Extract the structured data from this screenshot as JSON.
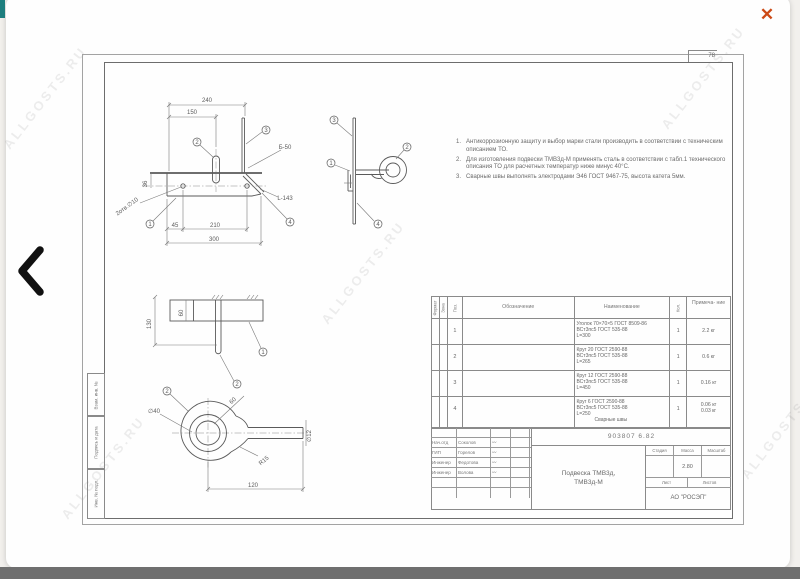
{
  "viewer": {
    "close_glyph": "✕",
    "watermark": "ALLGOSTS.RU"
  },
  "sheet": {
    "page_number": "78",
    "margin_labels": {
      "vzam": "Взам. инв. №",
      "podpis": "Подпись и дата",
      "inv": "Инв. № подл."
    }
  },
  "notes": {
    "items": [
      {
        "num": "1.",
        "text": "Антикоррозионную защиту и выбор марки стали производить в соответствии с техническим описанием ТО."
      },
      {
        "num": "2.",
        "text": "Для изготовления подвески ТМВ3д-М применять сталь в соответствии с табл.1 технического описания ТО для расчетных температур ниже минус 40°С."
      },
      {
        "num": "3.",
        "text": "Сварные швы выполнять электродами Э46 ГОСТ 9467-75, высота катета 5мм."
      }
    ]
  },
  "views": {
    "v1": {
      "dim_240": "240",
      "dim_150": "150",
      "dim_36": "36",
      "dim_45": "45",
      "dim_210": "210",
      "dim_300": "300",
      "holes_label": "2отв.∅10",
      "weld_label": "Б-50",
      "right_label": "L-143",
      "balloon_1": "1",
      "balloon_2": "2",
      "balloon_3": "3",
      "balloon_4": "4"
    },
    "v2": {
      "balloon_1": "1",
      "balloon_2": "2",
      "balloon_3": "3",
      "balloon_4": "4"
    },
    "v3": {
      "dim_130": "130",
      "dim_60": "60",
      "balloon_1": "1",
      "balloon_2": "2"
    },
    "v4": {
      "dim_60": "60",
      "dia_40": "∅40",
      "r_15": "R15",
      "dia_12": "∅12",
      "dim_120": "120",
      "balloon_2": "2"
    }
  },
  "spec_table": {
    "headers": {
      "format": "Формат",
      "zone": "Зона",
      "pos": "Поз.",
      "designation": "Обозначение",
      "name": "Наименование",
      "qty": "Кол.",
      "note": "Примеча- ние"
    },
    "rows": [
      {
        "pos": "1",
        "name_l1": "Уголок 70×70×5 ГОСТ 8509-86",
        "name_l2": "ВСт3пс5 ГОСТ 535-88",
        "name_l3": "L=300",
        "qty": "1",
        "note": "2.2 кг"
      },
      {
        "pos": "2",
        "name_l1": "Круг 20 ГОСТ 2590-88",
        "name_l2": "ВСт3пс5 ГОСТ 535-88",
        "name_l3": "L=265",
        "qty": "1",
        "note": "0.6 кг"
      },
      {
        "pos": "3",
        "name_l1": "Круг 12 ГОСТ 2590-88",
        "name_l2": "ВСт3пс5 ГОСТ 535-88",
        "name_l3": "L=450",
        "qty": "1",
        "note": "0.16 кг"
      },
      {
        "pos": "4",
        "name_l1": "Круг 6 ГОСТ 2590-88",
        "name_l2": "ВСт3пс5 ГОСТ 535-88",
        "name_l3": "L=250",
        "qty": "1",
        "note": "0.06 кг",
        "extra": "Сварные швы",
        "extra_note": "0.03 кг"
      }
    ]
  },
  "title_block": {
    "doc_number": "903807 6.82",
    "sig_rows": [
      {
        "role": "Нач.отд",
        "name": "Соколов",
        "sig": "〰"
      },
      {
        "role": "ГИП",
        "name": "Горелов",
        "sig": "〰"
      },
      {
        "role": "Инженер",
        "name": "Федотова",
        "sig": "〰"
      },
      {
        "role": "Инженер",
        "name": "Волова",
        "sig": "〰"
      }
    ],
    "title_line1": "Подвеска ТМВ3д,",
    "title_line2": "ТМВ3д-М",
    "stage_label": "Стадия",
    "mass_label": "Масса",
    "scale_label": "Масштаб",
    "mass_value": "2.80",
    "sheet_label": "Лист",
    "sheets_label": "Листов",
    "company": "АО \"РОСЭП\""
  }
}
